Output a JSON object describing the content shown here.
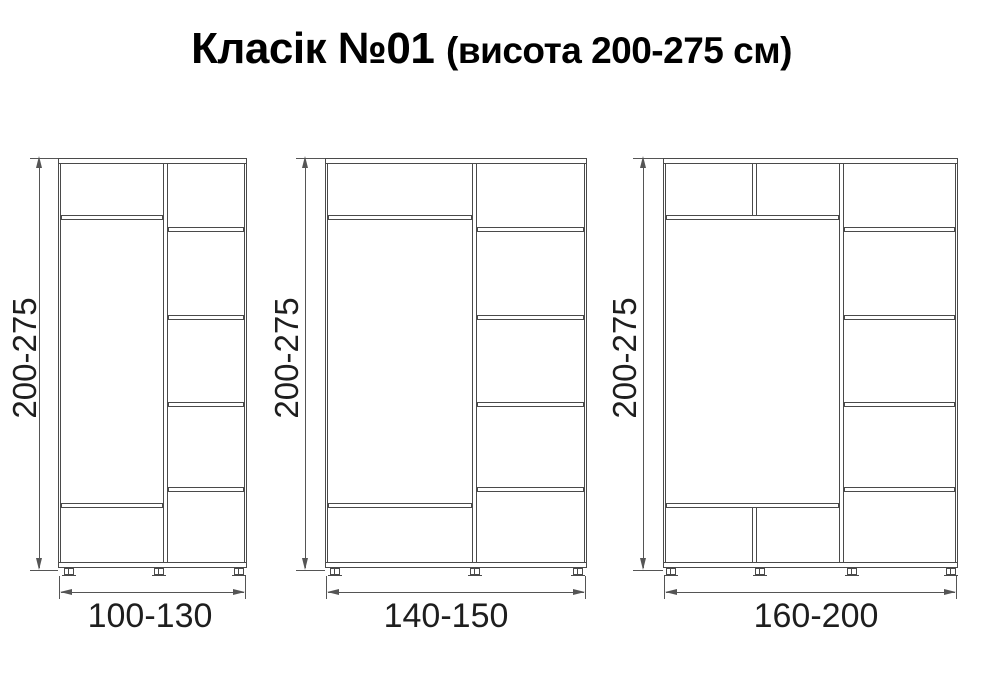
{
  "title": {
    "main": "Класік №01",
    "sub": "(висота 200-275 см)"
  },
  "cabinets": [
    {
      "height_label": "200-275",
      "width_label": "100-130"
    },
    {
      "height_label": "200-275",
      "width_label": "140-150"
    },
    {
      "height_label": "200-275",
      "width_label": "160-200"
    }
  ]
}
